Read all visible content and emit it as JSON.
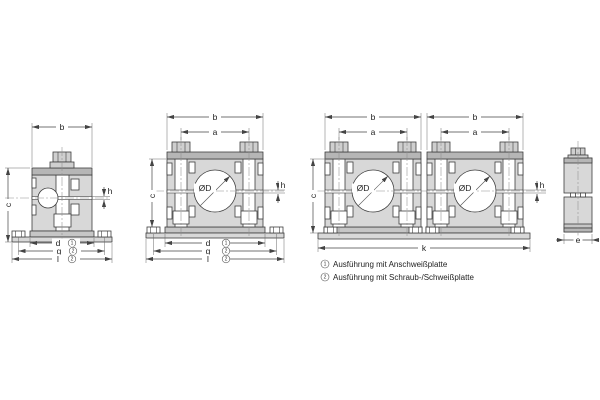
{
  "dims": {
    "a": "a",
    "b": "b",
    "c": "c",
    "d": "d",
    "e": "e",
    "g": "g",
    "h": "h",
    "k": "k",
    "l": "l",
    "dia": "ØD"
  },
  "markers": {
    "plate1": "1",
    "plate2": "2"
  },
  "legend": {
    "items": [
      {
        "num": "1",
        "text": "Ausführung mit Anschweißplatte"
      },
      {
        "num": "2",
        "text": "Ausführung mit Schraub-/Schweißplatte"
      }
    ]
  },
  "colors": {
    "background": "#ffffff",
    "clamp_body": "#d8d8d8",
    "cover_plate": "#b6b6b6",
    "weld_plate": "#c6c6c6",
    "outline": "#3e3e3e",
    "dimension_line": "#444444",
    "centerline": "#8f8f8f"
  }
}
